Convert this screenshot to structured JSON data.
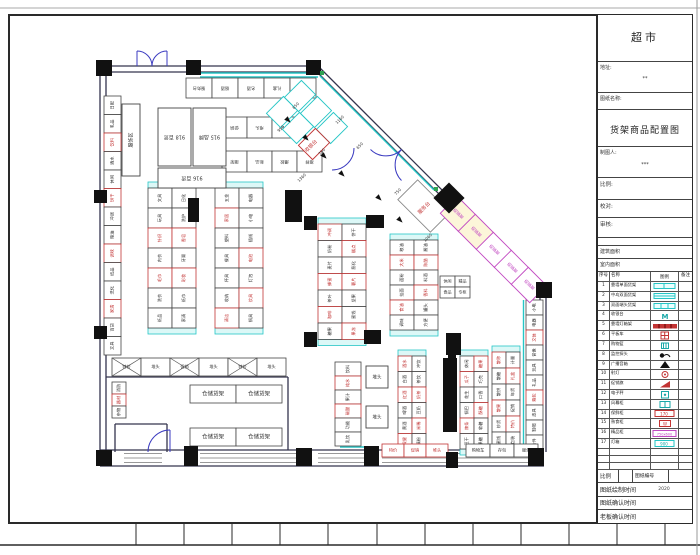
{
  "title_block": {
    "supermarket": "超市",
    "address_label": "地址:",
    "address_value": "**",
    "drawing_name_label": "图纸名称:",
    "drawing_title": "货架商品配置图",
    "drafter_label": "制图人:",
    "drafter_value": "***",
    "scale_label": "比例:",
    "proof_label": "校对:",
    "review_label": "审核:",
    "building_area_label": "建筑面积",
    "interior_area_label": "室内面积",
    "footer": {
      "scale_label": "比例",
      "drawing_no_label": "图纸编号",
      "draw_time_label": "图纸绘制时间",
      "draw_time_value": "2020",
      "confirm_time_label": "图纸确认时间",
      "boss_time_label": "老板确认时间"
    }
  },
  "legend": {
    "header": [
      "序号",
      "名称",
      "图例",
      "备注"
    ],
    "rows": [
      {
        "no": "1",
        "name": "靠墙单面货架",
        "sym": "shelf1"
      },
      {
        "no": "2",
        "name": "中岛双面货架",
        "sym": "shelf2"
      },
      {
        "no": "3",
        "name": "双面端头货架",
        "sym": "shelf3"
      },
      {
        "no": "4",
        "name": "收银台",
        "sym": "mtext"
      },
      {
        "no": "5",
        "name": "靠墙灯箱架",
        "sym": "redbar"
      },
      {
        "no": "6",
        "name": "平板车",
        "sym": "redgrid"
      },
      {
        "no": "7",
        "name": "购物篮",
        "sym": "basket"
      },
      {
        "no": "8",
        "name": "监控探头",
        "sym": "camera"
      },
      {
        "no": "9",
        "name": "广播音箱",
        "sym": "speaker"
      },
      {
        "no": "10",
        "name": "射灯",
        "sym": "spotlight"
      },
      {
        "no": "11",
        "name": "促销旗",
        "sym": "flag"
      },
      {
        "no": "12",
        "name": "电子秤",
        "sym": "scale"
      },
      {
        "no": "13",
        "name": "风幕柜",
        "sym": "tealicon"
      },
      {
        "no": "14",
        "name": "保鲜柜",
        "sym": "redbox"
      },
      {
        "no": "15",
        "name": "熟食柜",
        "sym": "redbox2"
      },
      {
        "no": "16",
        "name": "精品柜",
        "sym": "magentabox"
      },
      {
        "no": "17",
        "name": "灯箱",
        "sym": "cyanbox"
      },
      {
        "no": "",
        "name": "",
        "sym": ""
      },
      {
        "no": "",
        "name": "",
        "sym": ""
      },
      {
        "no": "",
        "name": "",
        "sym": ""
      }
    ]
  },
  "plan": {
    "colors": {
      "wall": "#34344e",
      "cyan": "#26c6c6",
      "cyanFill": "#dcf8f7",
      "red": "#c23434",
      "magenta": "#c24ac2",
      "blue": "#3b3bc0",
      "green": "#2fa352",
      "black": "#111111"
    },
    "frame": {
      "top_line_y": 8,
      "inner": [
        9,
        15,
        683,
        508
      ],
      "bottom_line_y": 545,
      "right_line_x": 697,
      "ticks": [
        136,
        184,
        232,
        280,
        328,
        377,
        425,
        473,
        521,
        569,
        617,
        665
      ]
    },
    "walls": [
      [
        100,
        66,
        318,
        66
      ],
      [
        100,
        72,
        318,
        72
      ],
      [
        318,
        66,
        542,
        290
      ],
      [
        316,
        71,
        538,
        293
      ],
      [
        540,
        290,
        540,
        452
      ],
      [
        546,
        290,
        546,
        452
      ],
      [
        100,
        66,
        100,
        466
      ],
      [
        106,
        66,
        106,
        466
      ],
      [
        100,
        450,
        544,
        450
      ],
      [
        100,
        466,
        544,
        466
      ],
      [
        106,
        377,
        288,
        377
      ],
      [
        288,
        377,
        288,
        450
      ],
      [
        115,
        424,
        167,
        424
      ],
      [
        115,
        424,
        115,
        452
      ],
      [
        167,
        424,
        167,
        452
      ]
    ],
    "window_segments": [
      [
        124,
        162
      ],
      [
        200,
        296
      ],
      [
        318,
        364
      ],
      [
        382,
        446
      ],
      [
        458,
        528
      ]
    ],
    "window_ys": [
      453.5,
      458,
      462.5
    ],
    "cyan_lines": [
      [
        200,
        73,
        318,
        73
      ],
      [
        200,
        77,
        318,
        77
      ],
      [
        320,
        76,
        434,
        190
      ],
      [
        523.5,
        300,
        523.5,
        448
      ],
      [
        468,
        447,
        534,
        447
      ],
      [
        340,
        447,
        378,
        447
      ],
      [
        202,
        374,
        214,
        374
      ]
    ],
    "doors": [
      "M 152 66 A 15 15 0 0 0 137 51",
      "M 152 66 A 15 15 0 0 1 167 51",
      "M 137 66 L 137 51",
      "M 167 66 L 167 51",
      "M 401.5 149.5 A 22 22 0 0 1 370.5 149.5",
      "M 401.5 149.5 A 22 22 0 0 0 401.5 180.5",
      "M 148 452 A 22 22 0 0 1 170 430",
      "M 170 452 L 170 430",
      "M 332 170 A 22 22 0 0 0 354 148"
    ],
    "columns": [
      [
        96,
        60,
        16,
        16
      ],
      [
        186,
        60,
        15,
        15
      ],
      [
        306,
        60,
        15,
        15
      ],
      [
        94,
        190,
        13,
        13
      ],
      [
        94,
        326,
        13,
        13
      ],
      [
        96,
        450,
        16,
        16
      ],
      [
        184,
        446,
        14,
        20
      ],
      [
        296,
        448,
        16,
        18
      ],
      [
        364,
        446,
        15,
        20
      ],
      [
        446,
        452,
        12,
        16
      ],
      [
        528,
        448,
        16,
        18
      ],
      [
        536,
        282,
        16,
        16
      ],
      [
        304,
        216,
        13,
        14
      ],
      [
        366,
        215,
        18,
        13
      ],
      [
        304,
        332,
        13,
        15
      ],
      [
        364,
        330,
        17,
        14
      ],
      [
        446,
        333,
        15,
        22
      ]
    ],
    "diamond": {
      "x": 449,
      "y": 198,
      "r": 11
    },
    "bars": [
      [
        285,
        190,
        17,
        32
      ],
      [
        188,
        198,
        11,
        24
      ],
      [
        443,
        358,
        14,
        74
      ],
      [
        448,
        352,
        8,
        12
      ]
    ],
    "greens": [
      [
        320,
        71
      ],
      [
        434,
        187
      ]
    ],
    "runs": [
      {
        "x": 104,
        "y": 96,
        "cols": 1,
        "rows": 14,
        "cw": 17,
        "ch": 18.5,
        "rot": -90,
        "red": [
          2,
          5,
          8,
          11
        ],
        "labels": [
          "日配",
          "乳品",
          "饮料",
          "酒水",
          "休闲",
          "饼干",
          "冲调",
          "粮油",
          "调味",
          "纸品",
          "洗化",
          "家清",
          "百货",
          "文具"
        ]
      },
      {
        "x": 186,
        "y": 78,
        "cols": 5,
        "rows": 1,
        "cw": 26,
        "ch": 20,
        "dir": "h",
        "rot": 180,
        "red": [],
        "labels": [
          "服务台",
          "烟酒",
          "名酒",
          "礼盒",
          "保健"
        ]
      },
      {
        "x": 222,
        "y": 117,
        "cols": 3,
        "rows": 1,
        "cw": 25,
        "ch": 21,
        "dir": "h",
        "rot": 180,
        "red": [],
        "labels": [
          "促销",
          "堆头",
          "特价"
        ]
      },
      {
        "x": 222,
        "y": 151,
        "cols": 4,
        "rows": 1,
        "cw": 25,
        "ch": 21,
        "dir": "h",
        "rot": 180,
        "red": [],
        "labels": [
          "端架",
          "新品",
          "爆款",
          "推荐"
        ]
      },
      {
        "x": 148,
        "y": 188,
        "cols": 2,
        "rows": 7,
        "cw": 24,
        "ch": 20,
        "caps": true,
        "rot": -90,
        "red": [
          2,
          4,
          9,
          11
        ],
        "labels": [
          "文具",
          "玩具",
          "针织",
          "内衣",
          "毛巾",
          "洗衣",
          "纸品",
          "日化",
          "洗护",
          "香皂",
          "牙膏",
          "彩妆",
          "纸巾",
          "家清"
        ]
      },
      {
        "x": 215,
        "y": 188,
        "cols": 2,
        "rows": 7,
        "cw": 24,
        "ch": 20,
        "caps": true,
        "rot": -90,
        "red": [
          1,
          6,
          10,
          12
        ],
        "labels": [
          "五金",
          "家居",
          "塑料",
          "餐具",
          "杯具",
          "收纳",
          "清洁",
          "电器",
          "小电",
          "插线",
          "电池",
          "灯泡",
          "炊具",
          "锅具"
        ]
      },
      {
        "x": 318,
        "y": 224,
        "cols": 2,
        "rows": 7,
        "cw": 24,
        "ch": 16.5,
        "caps": true,
        "rot": -90,
        "red": [
          0,
          3,
          5,
          8,
          10,
          13
        ],
        "labels": [
          "冲调",
          "奶粉",
          "麦片",
          "蜂蜜",
          "茶叶",
          "咖啡",
          "糖果",
          "饼干",
          "糕点",
          "膨化",
          "薯片",
          "坚果",
          "蜜饯",
          "果冻"
        ]
      },
      {
        "x": 390,
        "y": 240,
        "cols": 2,
        "rows": 6,
        "cw": 24,
        "ch": 15,
        "caps": true,
        "rot": -90,
        "red": [
          1,
          4,
          7,
          9
        ],
        "labels": [
          "粮油",
          "大米",
          "面粉",
          "挂面",
          "食油",
          "调味",
          "酱油",
          "陈醋",
          "料酒",
          "香料",
          "罐头",
          "方便"
        ]
      },
      {
        "x": 335,
        "y": 362,
        "cols": 1,
        "rows": 6,
        "cw": 26,
        "ch": 14,
        "rot": -90,
        "red": [
          1,
          3
        ],
        "labels": [
          "饮料",
          "纯水",
          "果汁",
          "碳酸",
          "功能",
          "乳饮"
        ]
      },
      {
        "x": 398,
        "y": 356,
        "cols": 2,
        "rows": 6,
        "cw": 14,
        "ch": 15.5,
        "caps": true,
        "rot": -90,
        "red": [
          0,
          2,
          5,
          8,
          10
        ],
        "labels": [
          "酒水",
          "白酒",
          "红酒",
          "啤酒",
          "黄酒",
          "保健",
          "冲饮",
          "茶饮",
          "奶茶",
          "豆奶",
          "米稀",
          "藕粉"
        ]
      },
      {
        "x": 460,
        "y": 356,
        "cols": 2,
        "rows": 6,
        "cw": 14,
        "ch": 15.5,
        "caps": true,
        "rot": -90,
        "red": [
          1,
          4,
          6,
          9
        ],
        "labels": [
          "休闲",
          "瓜子",
          "花生",
          "锅巴",
          "辣条",
          "豆干",
          "糖果",
          "巧克",
          "口香",
          "酥糖",
          "软糖",
          "果糖"
        ]
      },
      {
        "x": 492,
        "y": 352,
        "cols": 2,
        "rows": 6,
        "cw": 14,
        "ch": 16,
        "caps": true,
        "rot": -90,
        "red": [
          0,
          3,
          7,
          10
        ],
        "labels": [
          "散称",
          "散糖",
          "散饼",
          "散果",
          "炒货",
          "蜜饯",
          "计量",
          "礼盒",
          "年货",
          "促销",
          "特价",
          "包装"
        ]
      },
      {
        "x": 526,
        "y": 300,
        "cols": 1,
        "rows": 10,
        "cw": 17,
        "ch": 15,
        "rot": -90,
        "red": [
          2,
          6
        ],
        "labels": [
          "小电",
          "电器",
          "文体",
          "音像",
          "玩具",
          "礼品",
          "箱包",
          "皮具",
          "鞋帽",
          "杂件"
        ]
      },
      {
        "x": 112,
        "y": 358,
        "cols": 6,
        "rows": 1,
        "cw": 29,
        "ch": 18,
        "dir": "h",
        "rot": 0,
        "red": [],
        "cross": [
          0,
          2,
          4
        ],
        "labels": [
          "特价",
          "堆头",
          "促销",
          "堆头",
          "特价",
          "堆头"
        ]
      },
      {
        "x": 190,
        "y": 385,
        "cols": 2,
        "rows": 1,
        "cw": 46,
        "ch": 18,
        "dir": "h",
        "rot": 0,
        "fs": 5.5,
        "red": [],
        "labels": [
          "仓储货架",
          "仓储货架"
        ]
      },
      {
        "x": 190,
        "y": 428,
        "cols": 2,
        "rows": 1,
        "cw": 46,
        "ch": 18,
        "dir": "h",
        "rot": 0,
        "fs": 5.5,
        "red": [],
        "labels": [
          "仓储货架",
          "仓储货架"
        ]
      },
      {
        "x": 382,
        "y": 444,
        "cols": 3,
        "rows": 1,
        "cw": 22,
        "ch": 13,
        "dir": "h",
        "rot": 0,
        "red": [
          0,
          1,
          2
        ],
        "labels": [
          "特价",
          "促销",
          "堆头"
        ]
      },
      {
        "x": 466,
        "y": 444,
        "cols": 3,
        "rows": 1,
        "cw": 24,
        "ch": 13,
        "dir": "h",
        "rot": 0,
        "red": [],
        "labels": [
          "购物车",
          "存包",
          "服务"
        ]
      },
      {
        "x": 112,
        "y": 382,
        "cols": 1,
        "rows": 3,
        "cw": 14,
        "ch": 12,
        "rot": -90,
        "red": [
          1
        ],
        "labels": [
          "消防",
          "器材",
          "杂物"
        ]
      },
      {
        "x": 440,
        "y": 276,
        "cols": 2,
        "rows": 2,
        "cw": 15,
        "ch": 11,
        "dir": "grid",
        "rot": 0,
        "fs": 4,
        "red": [],
        "labels": [
          "休闲",
          "食品",
          "精品",
          "专柜"
        ]
      }
    ],
    "boxes": [
      {
        "x": 122,
        "y": 104,
        "w": 18,
        "h": 72,
        "label": "服饰区",
        "rot": -90,
        "fs": 5
      },
      {
        "x": 158,
        "y": 108,
        "w": 33,
        "h": 58,
        "label": "918 百货",
        "rot": 180,
        "fs": 5
      },
      {
        "x": 193,
        "y": 108,
        "w": 33,
        "h": 58,
        "label": "915 品牌",
        "rot": 180,
        "fs": 5
      },
      {
        "x": 158,
        "y": 168,
        "w": 68,
        "h": 20,
        "label": "916 百货",
        "rot": 180,
        "fs": 5
      },
      {
        "x": 366,
        "y": 366,
        "w": 22,
        "h": 22,
        "label": "堆头",
        "rot": 0,
        "fs": 4.5
      },
      {
        "x": 366,
        "y": 406,
        "w": 22,
        "h": 22,
        "label": "堆头",
        "rot": 0,
        "fs": 4.5
      }
    ],
    "diag_cells": [
      {
        "cx": 300,
        "cy": 96,
        "w": 20,
        "h": 24,
        "rot": 45,
        "stroke": "cyan"
      },
      {
        "cx": 316,
        "cy": 112,
        "w": 20,
        "h": 24,
        "rot": 45,
        "stroke": "cyan"
      },
      {
        "cx": 332,
        "cy": 128,
        "w": 20,
        "h": 24,
        "rot": 45,
        "stroke": "cyan"
      },
      {
        "cx": 282,
        "cy": 112,
        "w": 20,
        "h": 24,
        "rot": 45,
        "stroke": "cyan"
      },
      {
        "cx": 298,
        "cy": 128,
        "w": 20,
        "h": 24,
        "rot": 45,
        "stroke": "cyan"
      },
      {
        "cx": 314,
        "cy": 144,
        "w": 20,
        "h": 24,
        "rot": 45,
        "stroke": "red"
      },
      {
        "cx": 424,
        "cy": 206,
        "w": 46,
        "h": 28,
        "rot": 45,
        "stroke": "#888"
      },
      {
        "cx": 458,
        "cy": 214,
        "w": 26,
        "h": 24,
        "rot": 45,
        "stroke": "magenta",
        "fill": "#fcf6d9",
        "label": "促销架"
      },
      {
        "cx": 476,
        "cy": 232,
        "w": 26,
        "h": 24,
        "rot": 45,
        "stroke": "magenta",
        "fill": "#fcf6d9",
        "label": "促销架"
      },
      {
        "cx": 494,
        "cy": 250,
        "w": 26,
        "h": 24,
        "rot": 45,
        "stroke": "magenta",
        "label": "促销架"
      },
      {
        "cx": 512,
        "cy": 268,
        "w": 26,
        "h": 24,
        "rot": 45,
        "stroke": "magenta",
        "label": "促销架"
      },
      {
        "cx": 529,
        "cy": 285,
        "w": 26,
        "h": 24,
        "rot": 45,
        "stroke": "magenta",
        "label": "促销架"
      }
    ],
    "texts": [
      {
        "t": "收银台",
        "x": 311,
        "y": 146,
        "r": -45,
        "c": "red",
        "s": 5
      },
      {
        "t": "服务台",
        "x": 424,
        "y": 208,
        "r": -45,
        "c": "red",
        "s": 5
      }
    ],
    "dims": [
      {
        "t": "650",
        "x": 296,
        "y": 106
      },
      {
        "t": "950",
        "x": 281,
        "y": 129
      },
      {
        "t": "1160",
        "x": 340,
        "y": 120
      },
      {
        "t": "750",
        "x": 322,
        "y": 152
      },
      {
        "t": "650",
        "x": 360,
        "y": 146
      },
      {
        "t": "1360",
        "x": 302,
        "y": 178
      },
      {
        "t": "750",
        "x": 398,
        "y": 192
      },
      {
        "t": "1060",
        "x": 428,
        "y": 238
      }
    ],
    "arrows": [
      [
        286,
        118
      ],
      [
        304,
        136
      ],
      [
        322,
        154
      ],
      [
        340,
        172
      ],
      [
        377,
        196
      ],
      [
        398,
        218
      ]
    ]
  }
}
